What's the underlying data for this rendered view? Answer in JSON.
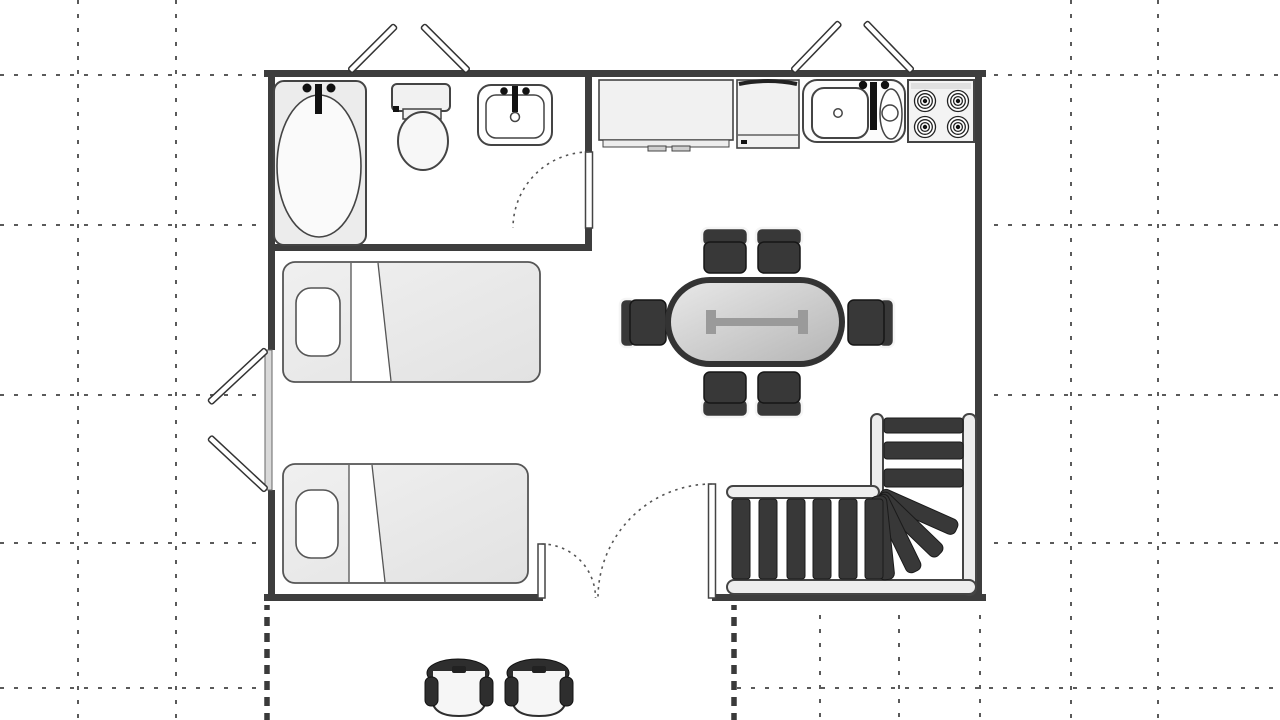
{
  "diagram": {
    "kind": "apartment floor plan, top-down architectural drawing",
    "rooms": [
      {
        "name": "bathroom",
        "position": "top-left",
        "fixtures": [
          "bathtub with faucet",
          "toilet",
          "washbasin with faucet"
        ]
      },
      {
        "name": "kitchen",
        "position": "top-right",
        "fixtures": [
          "countertop with drawer handles",
          "cabinet unit",
          "double-bowl sink with faucet",
          "stove with 4 coil burners"
        ]
      },
      {
        "name": "main-room",
        "position": "center",
        "furniture": [
          "oval dining table with 6 chairs",
          "single bed",
          "single bed"
        ]
      },
      {
        "name": "staircase",
        "position": "bottom-right",
        "details": "L-shaped stair: 3 upper treads, 4 fan winder treads, 6 straight lower treads"
      }
    ],
    "doors": [
      {
        "name": "top-left-double-door",
        "state": "open outward, two leaves"
      },
      {
        "name": "top-right-double-door",
        "state": "open outward, two leaves"
      },
      {
        "name": "left-double-door",
        "state": "open outward, two leaves"
      },
      {
        "name": "bathroom-door",
        "state": "dashed quarter-arc swing into bathroom"
      },
      {
        "name": "main-entrance-double-door",
        "state": "two unequal leaves, dashed quarter-arc swings"
      }
    ],
    "outside": {
      "patio_chairs": 2,
      "boundary": "bold dashed property lines below plan",
      "reference_grid": "dotted grid lines across canvas"
    },
    "counts": {
      "dining_chairs": 6,
      "stove_burners": 4,
      "beds": 2,
      "upper_treads": 3,
      "fan_treads": 4,
      "lower_treads": 6
    }
  },
  "colors": {
    "wall": "#3d3d3d",
    "grid": "#5a5a5a",
    "boundary_dashed": "#3a3a3a",
    "outline": "#444444",
    "fixture_fill": "#f1f1f1",
    "white": "#ffffff",
    "dark_furniture": "#383838",
    "table_border": "#333333",
    "ibeam": "#9a9a9a",
    "bed_fill": "#ececec",
    "stringer_fill": "#ededed",
    "patio_dark": "#2e2e2e",
    "patio_seat": "#f6f6f6"
  }
}
